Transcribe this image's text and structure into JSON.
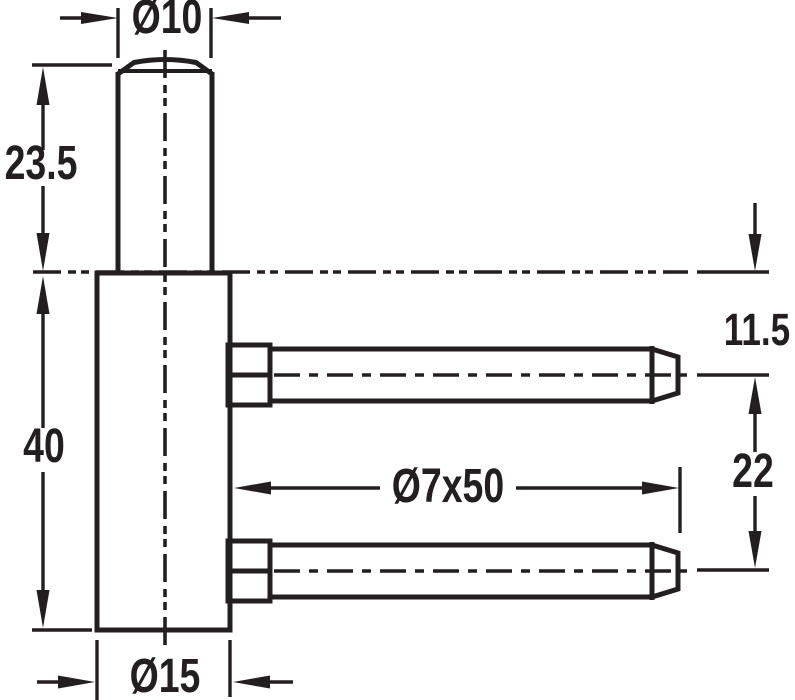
{
  "drawing": {
    "type": "technical-drawing",
    "units": "mm",
    "colors": {
      "line": "#231f20",
      "background": "#ffffff"
    },
    "labels": {
      "pin_diameter": "Ø10",
      "pin_length": "23.5",
      "body_length": "40",
      "body_diameter": "Ø15",
      "screw_dimension": "Ø7x50",
      "top_to_first_screw": "11.5",
      "screw_spacing": "22"
    }
  }
}
